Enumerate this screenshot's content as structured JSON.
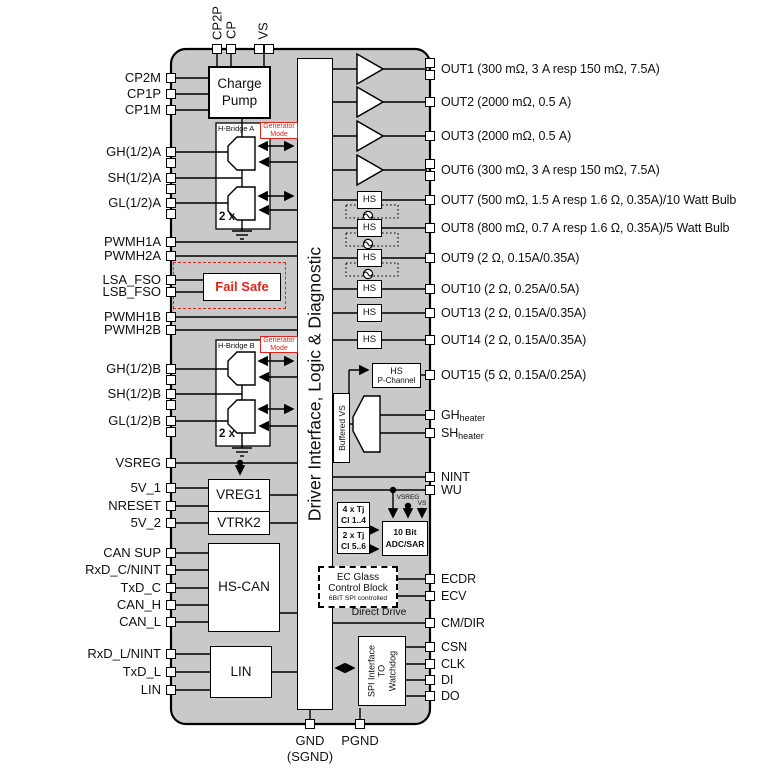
{
  "central_block_label": "Driver Interface, Logic & Diagnostic",
  "top_pins": [
    {
      "label": "CP2P"
    },
    {
      "label": "CP"
    },
    {
      "label": "VS"
    }
  ],
  "left_pins": [
    {
      "label": "CP2M",
      "y": 78
    },
    {
      "label": "CP1P",
      "y": 94
    },
    {
      "label": "CP1M",
      "y": 110
    },
    {
      "label": "GH(1/2)A",
      "y": 152,
      "double": true
    },
    {
      "label": "SH(1/2)A",
      "y": 178,
      "double": true
    },
    {
      "label": "GL(1/2)A",
      "y": 203,
      "double": true
    },
    {
      "label": "PWMH1A",
      "y": 242
    },
    {
      "label": "PWMH2A",
      "y": 256
    },
    {
      "label": "LSA_FSO",
      "y": 280
    },
    {
      "label": "LSB_FSO",
      "y": 292
    },
    {
      "label": "PWMH1B",
      "y": 317
    },
    {
      "label": "PWMH2B",
      "y": 330
    },
    {
      "label": "GH(1/2)B",
      "y": 369,
      "double": true
    },
    {
      "label": "SH(1/2)B",
      "y": 394,
      "double": true
    },
    {
      "label": "GL(1/2)B",
      "y": 421,
      "double": true
    },
    {
      "label": "VSREG",
      "y": 463
    },
    {
      "label": "5V_1",
      "y": 488
    },
    {
      "label": "NRESET",
      "y": 506
    },
    {
      "label": "5V_2",
      "y": 523
    },
    {
      "label": "CAN SUP",
      "y": 553
    },
    {
      "label": "RxD_C/NINT",
      "y": 570
    },
    {
      "label": "TxD_C",
      "y": 588
    },
    {
      "label": "CAN_H",
      "y": 605
    },
    {
      "label": "CAN_L",
      "y": 622
    },
    {
      "label": "RxD_L/NINT",
      "y": 654
    },
    {
      "label": "TxD_L",
      "y": 672
    },
    {
      "label": "LIN",
      "y": 690
    }
  ],
  "right_pins": [
    {
      "label": "OUT1 (300 mΩ, 3 A resp 150 mΩ, 7.5A)",
      "y": 69,
      "double": true
    },
    {
      "label": "OUT2 (2000 mΩ, 0.5 A)",
      "y": 102
    },
    {
      "label": "OUT3 (2000 mΩ, 0.5 A)",
      "y": 136
    },
    {
      "label": "OUT6 (300 mΩ, 3 A resp 150 mΩ, 7.5A)",
      "y": 170,
      "double": true
    },
    {
      "label": "OUT7 (500 mΩ, 1.5 A resp 1.6 Ω, 0.35A)/10 Watt Bulb",
      "y": 200
    },
    {
      "label": "OUT8 (800 mΩ, 0.7 A resp 1.6 Ω, 0.35A)/5 Watt Bulb",
      "y": 228
    },
    {
      "label": "OUT9 (2 Ω, 0.15A/0.35A)",
      "y": 258
    },
    {
      "label": "OUT10 (2 Ω, 0.25A/0.5A)",
      "y": 289
    },
    {
      "label": "OUT13 (2 Ω, 0.15A/0.35A)",
      "y": 313
    },
    {
      "label": "OUT14 (2 Ω, 0.15A/0.35A)",
      "y": 340
    },
    {
      "label": "OUT15 (5 Ω, 0.15A/0.25A)",
      "y": 375
    },
    {
      "label": "GH",
      "sub": "heater",
      "y": 415
    },
    {
      "label": "SH",
      "sub": "heater",
      "y": 433
    },
    {
      "label": "NINT",
      "y": 477
    },
    {
      "label": "WU",
      "y": 490
    },
    {
      "label": "ECDR",
      "y": 579
    },
    {
      "label": "ECV",
      "y": 596
    },
    {
      "label": "CM/DIR",
      "y": 623
    },
    {
      "label": "CSN",
      "y": 647
    },
    {
      "label": "CLK",
      "y": 664
    },
    {
      "label": "DI",
      "y": 680
    },
    {
      "label": "DO",
      "y": 696
    }
  ],
  "bottom_pins": {
    "gnd": "GND",
    "sgnd": "(SGND)",
    "pgnd": "PGND"
  },
  "blocks": {
    "charge_pump": "Charge Pump",
    "h_bridge_a": "H-Bridge A",
    "h_bridge_b": "H-Bridge B",
    "generator_mode": "Generator Mode",
    "two_x": "2 x",
    "fail_safe": "Fail Safe",
    "vreg1": "VREG1",
    "vtrk2": "VTRK2",
    "hs_can": "HS-CAN",
    "lin": "LIN",
    "hs": "HS",
    "hs_p_channel_top": "HS",
    "hs_p_channel_bottom": "P-Channel",
    "buffered_vs": "Buffered VS",
    "tj1_line1": "4 x Tj",
    "tj1_line2": "Cl 1..4",
    "tj2_line1": "2 x Tj",
    "tj2_line2": "Cl 5..6",
    "adc_line1": "10 Bit",
    "adc_line2": "ADC/SAR",
    "vsreg_tag": "VSREG",
    "vs_tag": "VS",
    "ec_line1": "EC Glass",
    "ec_line2": "Control Block",
    "ec_line3": "6BIT SPI controlled",
    "direct_drive": "Direct Drive",
    "spi_line1": "SPI Interface",
    "spi_line2": "TO",
    "spi_line3": "Watchdog"
  },
  "colors": {
    "body": "#c9c9c9",
    "accent_red": "#e2231a",
    "line": "#000000"
  }
}
